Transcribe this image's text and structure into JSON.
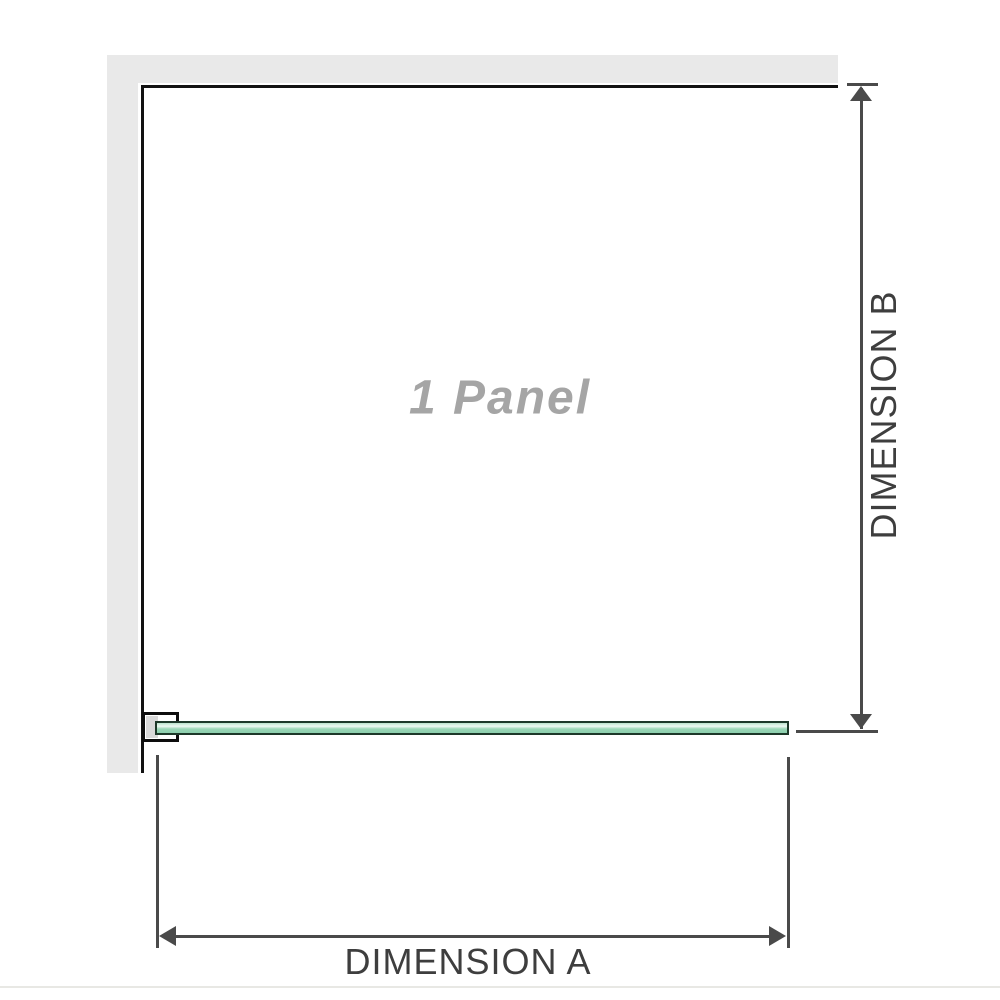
{
  "diagram": {
    "panel_label": "1 Panel",
    "dimension_a": {
      "label": "DIMENSION A",
      "orientation": "horizontal"
    },
    "dimension_b": {
      "label": "DIMENSION B",
      "orientation": "vertical"
    },
    "colors": {
      "wall": "#e9e9e9",
      "outline": "#121212",
      "dimension": "#4a4a4a",
      "label_text": "#3e3e3e",
      "panel_text": "#a5a5a5",
      "glass_border": "#1d3829",
      "glass_green": "#9ad6b6",
      "glass_highlight": "#eef9f2",
      "divider": "#e8e8e4"
    }
  }
}
